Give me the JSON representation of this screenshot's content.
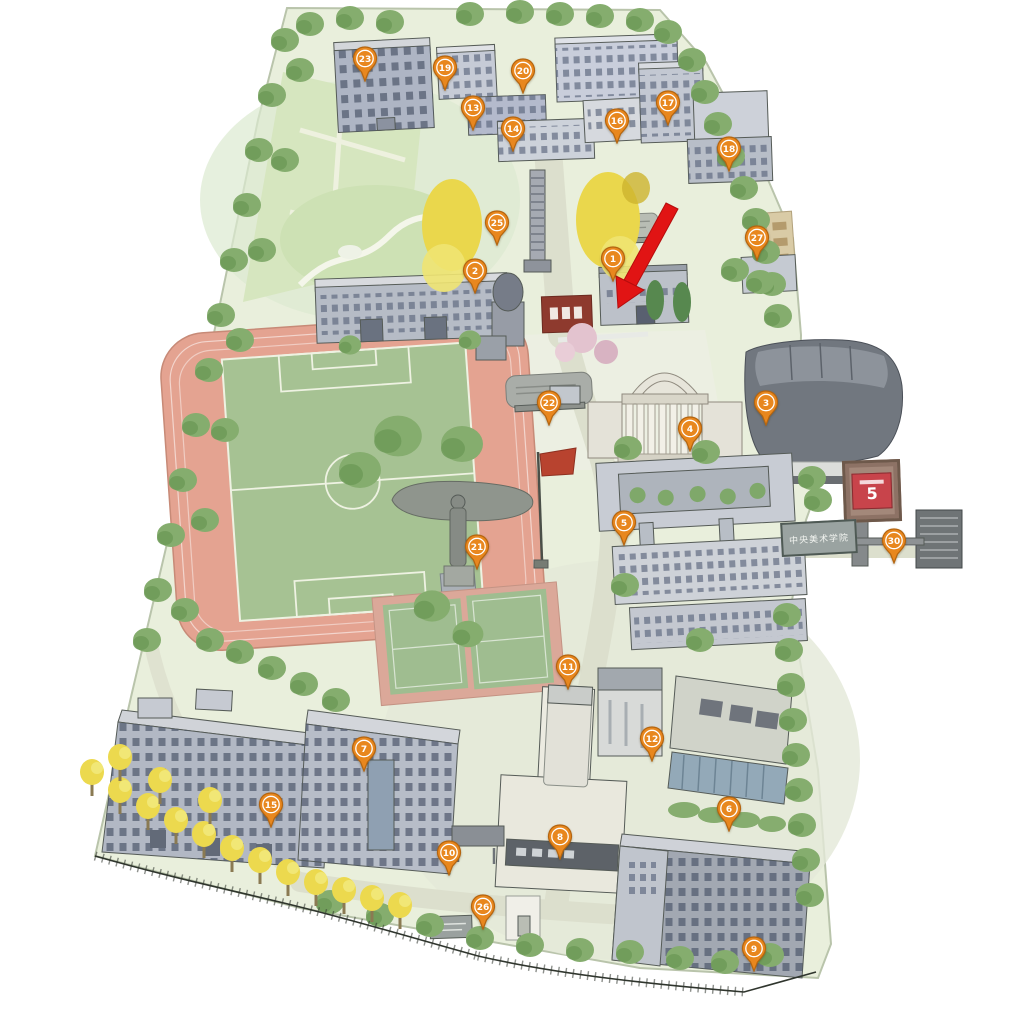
{
  "map": {
    "style": "hand-drawn illustrated campus bird's-eye map",
    "background": "#ffffff",
    "pin_color": "#e8871e",
    "pin_border_color": "#b5650f",
    "arrow_color": "#e01414"
  },
  "pins": [
    {
      "number": "23",
      "x": 365,
      "y": 58
    },
    {
      "number": "19",
      "x": 445,
      "y": 67
    },
    {
      "number": "20",
      "x": 523,
      "y": 70
    },
    {
      "number": "13",
      "x": 473,
      "y": 107
    },
    {
      "number": "14",
      "x": 513,
      "y": 128
    },
    {
      "number": "16",
      "x": 617,
      "y": 120
    },
    {
      "number": "17",
      "x": 668,
      "y": 102
    },
    {
      "number": "18",
      "x": 729,
      "y": 148
    },
    {
      "number": "25",
      "x": 497,
      "y": 222
    },
    {
      "number": "2",
      "x": 475,
      "y": 270
    },
    {
      "number": "1",
      "x": 613,
      "y": 258
    },
    {
      "number": "27",
      "x": 757,
      "y": 237
    },
    {
      "number": "22",
      "x": 549,
      "y": 402
    },
    {
      "number": "4",
      "x": 690,
      "y": 428
    },
    {
      "number": "3",
      "x": 766,
      "y": 402
    },
    {
      "number": "5",
      "x": 624,
      "y": 522
    },
    {
      "number": "30",
      "x": 894,
      "y": 540
    },
    {
      "number": "21",
      "x": 477,
      "y": 546
    },
    {
      "number": "11",
      "x": 568,
      "y": 666
    },
    {
      "number": "12",
      "x": 652,
      "y": 738
    },
    {
      "number": "6",
      "x": 729,
      "y": 808
    },
    {
      "number": "7",
      "x": 364,
      "y": 748
    },
    {
      "number": "15",
      "x": 271,
      "y": 804
    },
    {
      "number": "10",
      "x": 449,
      "y": 852
    },
    {
      "number": "8",
      "x": 560,
      "y": 836
    },
    {
      "number": "26",
      "x": 483,
      "y": 906
    },
    {
      "number": "9",
      "x": 754,
      "y": 948
    }
  ],
  "signs": {
    "building_number_plate": "5",
    "campus_name_plate": "中央美术学院"
  }
}
